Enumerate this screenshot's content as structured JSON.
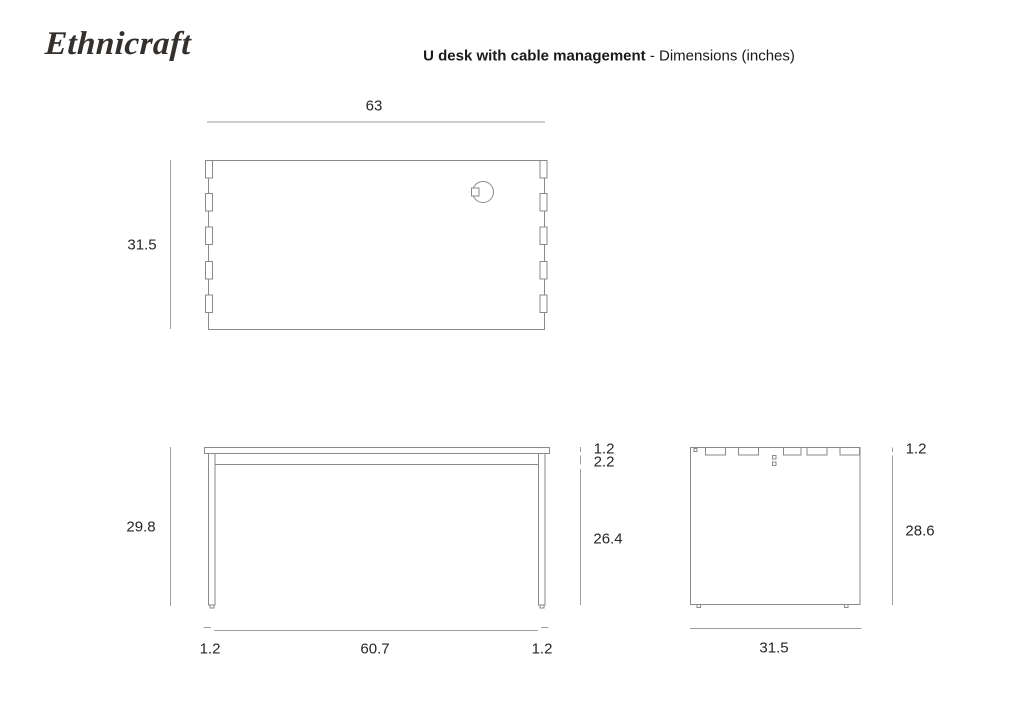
{
  "header": {
    "logo_text": "Ethnicraft",
    "title_bold": "U desk with cable management",
    "title_regular": " - Dimensions (inches)"
  },
  "colors": {
    "object_line": "#8a8a8a",
    "dimension_line": "#9e9e9e",
    "label_text": "#262626",
    "title_text": "#1a1a1a",
    "logo_text": "#33302d"
  },
  "dimensions": {
    "top_view": {
      "width": "63",
      "depth": "31.5"
    },
    "front_view": {
      "total_height": "29.8",
      "top_thickness": "1.2",
      "frame_depth": "2.2",
      "leg_clearance": "26.4",
      "left_leg_width": "1.2",
      "inner_span": "60.7",
      "right_leg_width": "1.2"
    },
    "side_view": {
      "top_thickness": "1.2",
      "panel_height": "28.6",
      "depth": "31.5"
    }
  }
}
